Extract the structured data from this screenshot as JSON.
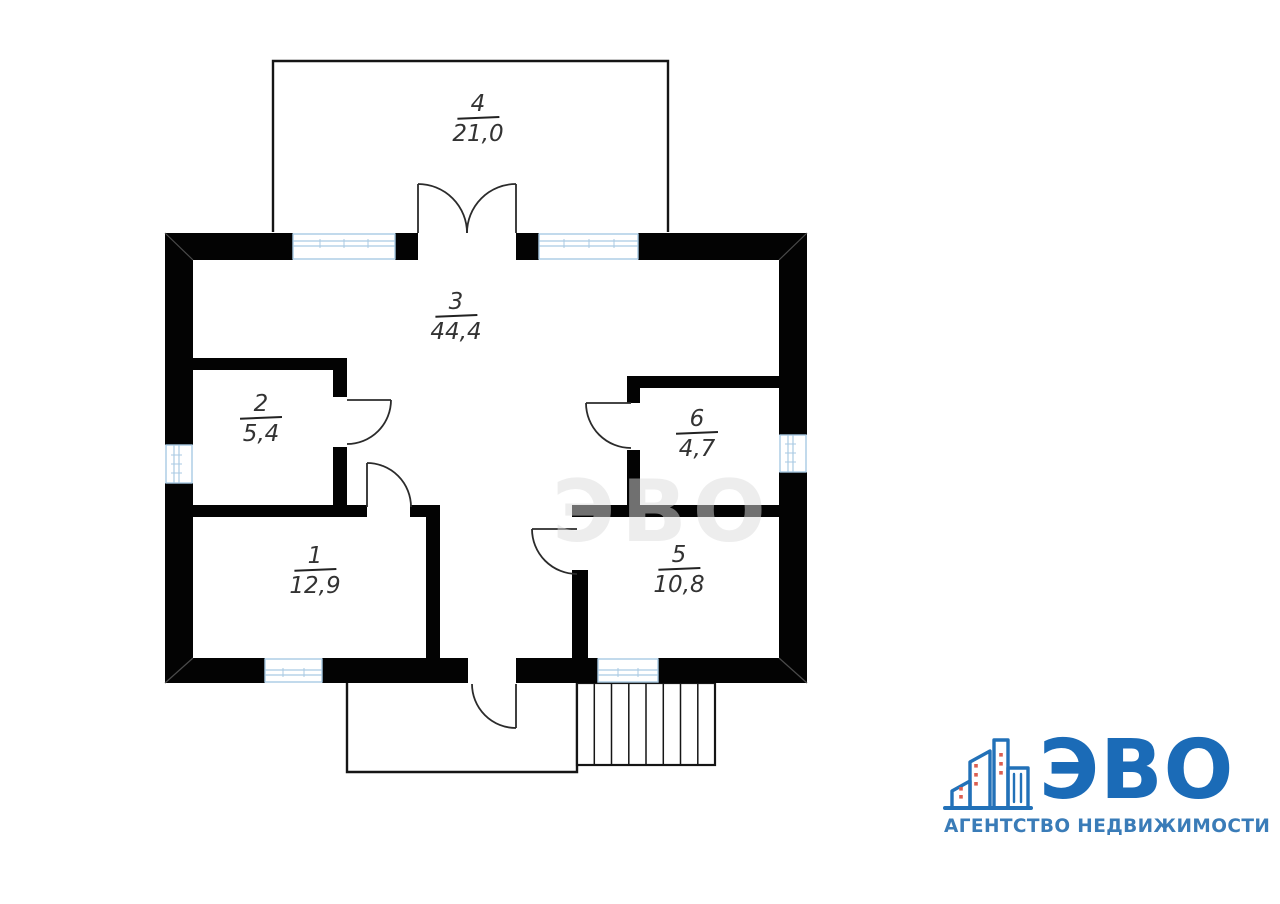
{
  "plan": {
    "watermark": "ЭВО",
    "wall_color": "#030303",
    "window_color": "#a9cae3",
    "rooms": [
      {
        "number": "1",
        "area": "12,9"
      },
      {
        "number": "2",
        "area": "5,4"
      },
      {
        "number": "3",
        "area": "44,4"
      },
      {
        "number": "4",
        "area": "21,0"
      },
      {
        "number": "5",
        "area": "10,8"
      },
      {
        "number": "6",
        "area": "4,7"
      }
    ]
  },
  "logo": {
    "name": "ЭВО",
    "tagline": "АГЕНТСТВО НЕДВИЖИМОСТИ",
    "brand_color": "#1b6bb7",
    "tagline_color": "#3a7cb8",
    "accent_color": "#db5f51"
  }
}
